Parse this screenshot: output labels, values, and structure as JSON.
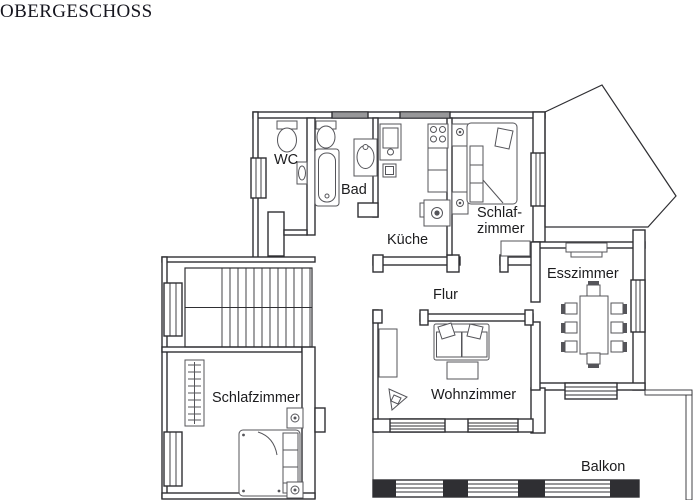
{
  "title": "OBERGESCHOSS",
  "rooms": {
    "wc": "WC",
    "bad": "Bad",
    "kueche": "Küche",
    "schlafzimmer_top_line1": "Schlaf-",
    "schlafzimmer_top_line2": "zimmer",
    "esszimmer": "Esszimmer",
    "flur": "Flur",
    "wohnzimmer": "Wohnzimmer",
    "schlafzimmer_bottom": "Schlafzimmer",
    "balkon": "Balkon"
  },
  "colors": {
    "background": "#ffffff",
    "wall_line": "#2f2f33",
    "furniture_line": "#55555a",
    "label_text": "#1c1c1e",
    "title_text": "#16161f"
  }
}
